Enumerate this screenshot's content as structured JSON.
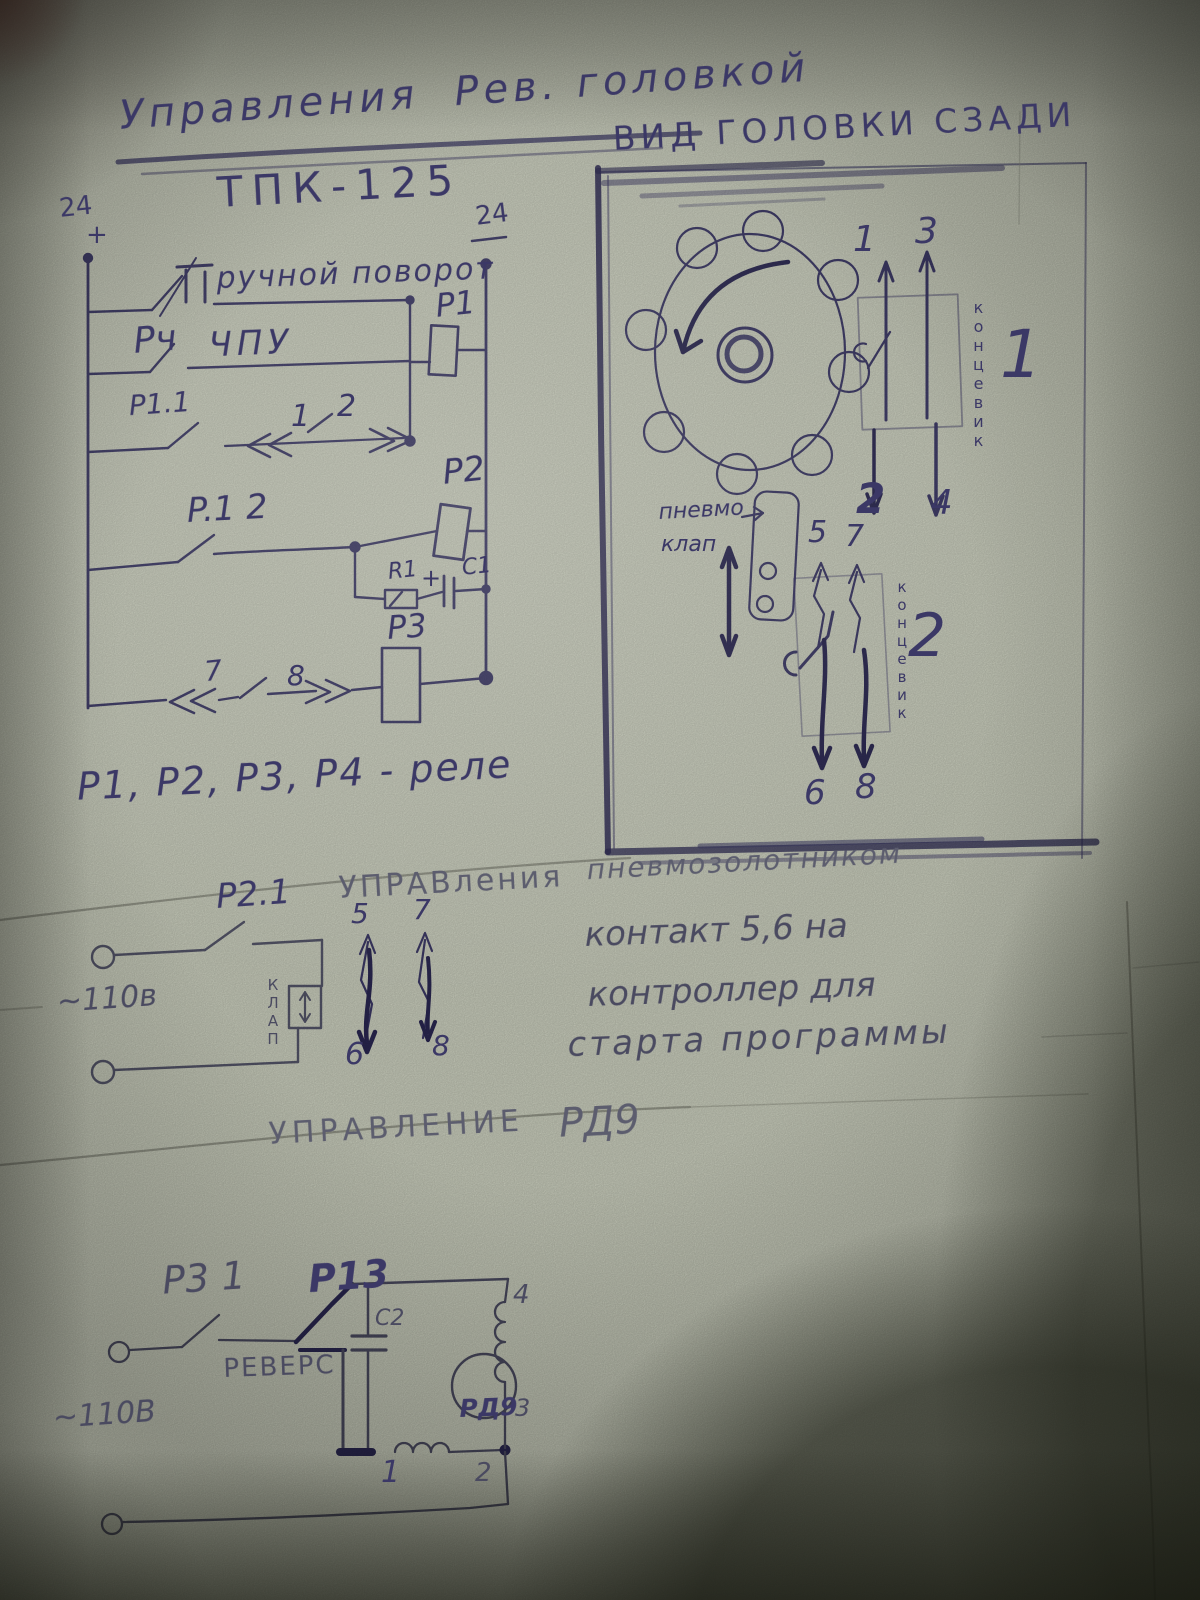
{
  "colors": {
    "paper": "#ccd0bf",
    "ink": "#3b3866",
    "ink_bold": "#2a2752",
    "pencil": "#8f9184"
  },
  "title": {
    "line1": "Управления  Рев. головкой",
    "line2": "ТПК-125"
  },
  "turret_circuit": {
    "bus_left_top": "24",
    "bus_left_plus": "+",
    "bus_right_top": "24",
    "manual_turn": "ручной поворот",
    "relay_p4_contact": "Рч",
    "cnc": "ЧПУ",
    "contact_p11": "P1.1",
    "pos_1": "1",
    "pos_2": "2",
    "relay_p1": "P1",
    "contact_p12": "P.1 2",
    "relay_p2": "P2",
    "resistor_r1": "R1",
    "plus": "+",
    "cap_c1": "C1",
    "relay_p3": "P3",
    "pos_7": "7",
    "pos_8": "8",
    "legend": "P1, P2, P3, P4 - реле"
  },
  "head_view": {
    "title": "ВИД ГОЛОВКИ СЗАДИ",
    "pneumo_word1": "пневмо",
    "pneumo_word2": "клап",
    "limit_switch_1": {
      "label_vertical": "концевик",
      "number": "1",
      "t1": "1",
      "t2": "2",
      "t3": "3",
      "t4": "4"
    },
    "limit_switch_2": {
      "label_vertical": "концевик",
      "number": "2",
      "t5": "5",
      "t6": "6",
      "t7": "7",
      "t8": "8"
    }
  },
  "pneumo_circuit": {
    "heading_word1": "УПРАВления",
    "heading_word2": "пневмозолотником",
    "contact_p21": "P2.1",
    "voltage": "~110в",
    "valve_vertical": "КЛАП",
    "t5": "5",
    "t6": "6",
    "t7": "7",
    "t8": "8",
    "note1": "контакт 5,6 на",
    "note2": "контроллер для",
    "note3": "старта программы"
  },
  "rd9_circuit": {
    "heading1": "УПРАВЛЕНИЕ",
    "heading2": "РД9",
    "contact_p31": "P3 1",
    "contact_p13": "P13",
    "reverse": "РЕВЕРС",
    "cap_c2": "C2",
    "motor": "РД9",
    "voltage": "~110В",
    "t1": "1",
    "t2": "2",
    "t3": "3",
    "t4": "4"
  }
}
